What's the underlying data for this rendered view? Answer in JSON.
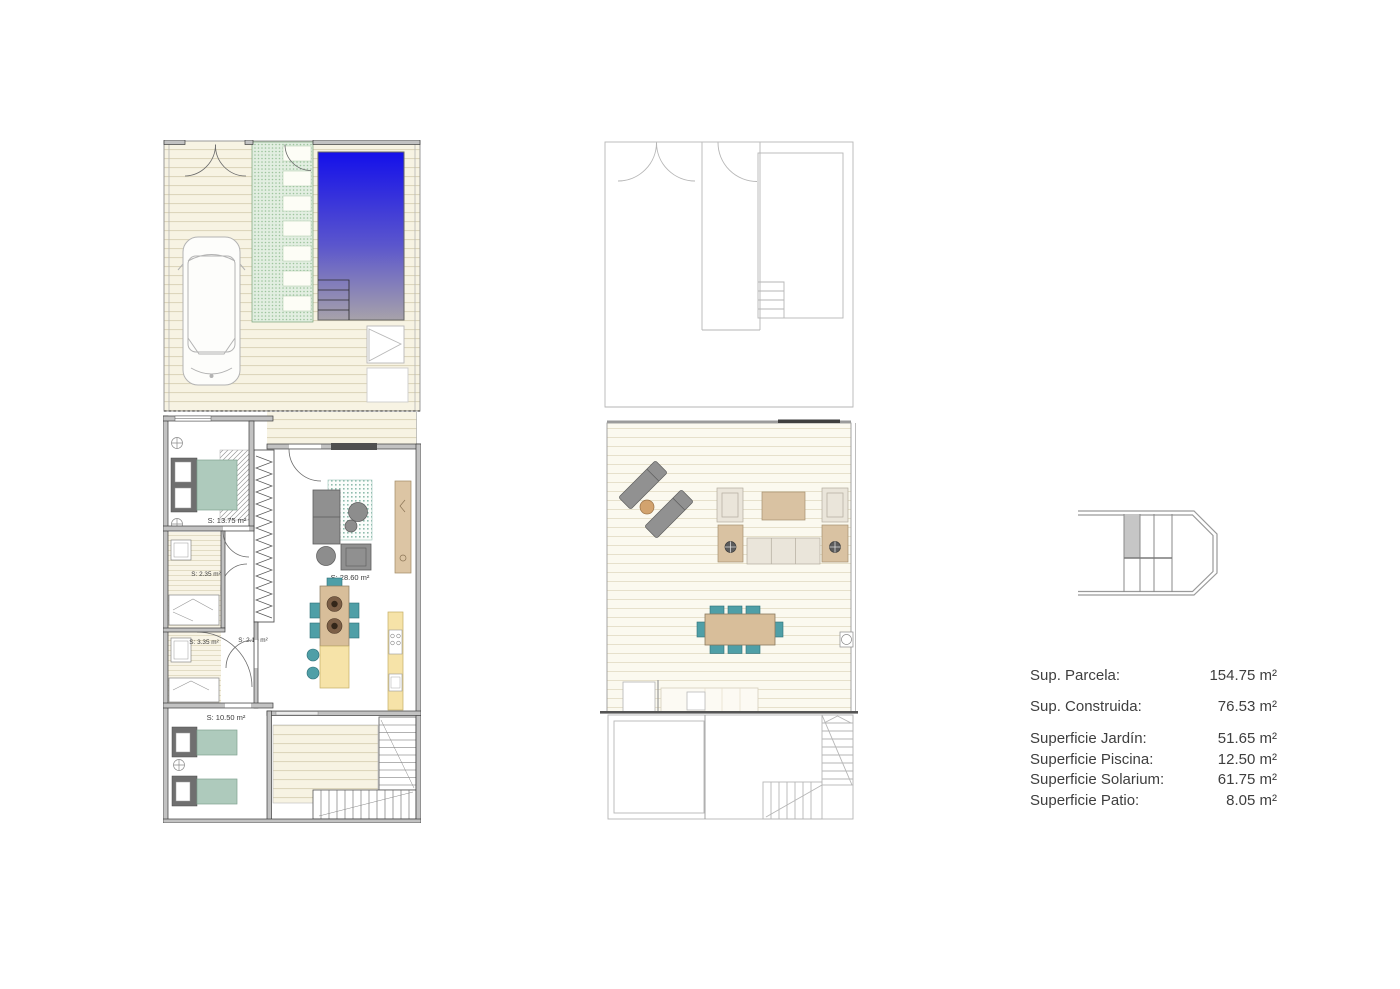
{
  "ground_floor": {
    "rooms": {
      "bedroom_main": "S: 13.75 m²",
      "bath_1": "S: 2.35 m²",
      "bath_2": "S: 3.35 m²",
      "hall": "S: 2.10 m²",
      "living": "S: 28.60 m²",
      "bedroom_2": "S: 10.50 m²"
    }
  },
  "legend": {
    "rows": [
      {
        "label": "Sup. Parcela:",
        "value": "154.75 m²"
      },
      {
        "label": "Sup. Construida:",
        "value": "76.53 m²"
      },
      {
        "label": "Superficie Jardín:",
        "value": "51.65 m²"
      },
      {
        "label": "Superficie Piscina:",
        "value": "12.50 m²"
      },
      {
        "label": "Superficie Solarium:",
        "value": "61.75 m²"
      },
      {
        "label": "Superficie Patio:",
        "value": "8.05 m²"
      }
    ]
  },
  "colors": {
    "pool_top": "#1410ea",
    "pool_mid": "#5a55cd",
    "pool_bottom": "#a7a2aa",
    "lawn_green": "#9dc49d",
    "deck_line": "#ddd6bc",
    "furniture_teal": "#aecabc",
    "chair_teal": "#4f9fa7",
    "counter_yellow": "#f6e3a8",
    "wood_tan": "#d8be9a",
    "sofa_gray": "#909090",
    "wall_gray": "#c2c2c2"
  }
}
